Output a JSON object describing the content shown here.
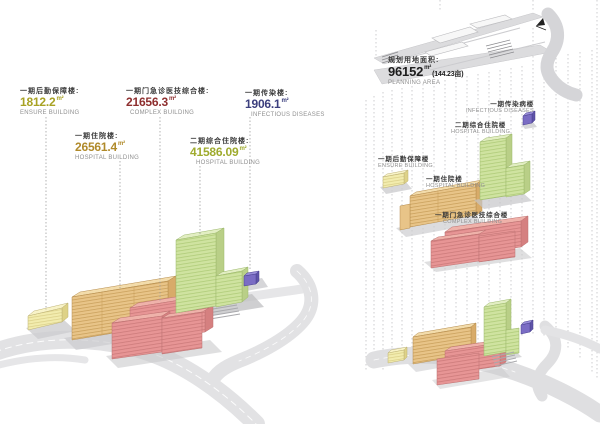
{
  "diagram_left": {
    "title": "phase-building-areas",
    "labels": [
      {
        "id": "ensure",
        "zh": "一期后勤保障楼:",
        "value": "1812.2",
        "unit": "m²",
        "en": "ENSURE BUILDING",
        "color": "#a8a224"
      },
      {
        "id": "complex",
        "zh": "一期门急诊医技综合楼:",
        "value": "21656.3",
        "unit": "m²",
        "en": "COMPLEX BUILDING",
        "color": "#8e2f2f"
      },
      {
        "id": "infectious",
        "zh": "一期传染楼:",
        "value": "1906.1",
        "unit": "m²",
        "en": "INFECTIOUS DISEASES",
        "color": "#3c3f7e"
      },
      {
        "id": "hospital1",
        "zh": "一期住院楼:",
        "value": "26561.4",
        "unit": "m²",
        "en": "HOSPITAL BUILDING",
        "color": "#b08a2a"
      },
      {
        "id": "hospital2",
        "zh": "二期综合住院楼:",
        "value": "41586.09",
        "unit": "m²",
        "en": "HOSPITAL BUILDING",
        "color": "#9fab2e"
      }
    ]
  },
  "diagram_right": {
    "title": "exploded-site-plan",
    "planning": {
      "zh": "规划用地面积:",
      "value": "96152",
      "unit": "m²",
      "extra": "(144.23亩)",
      "en": "PLANNING AREA",
      "color": "#1c1c1c"
    },
    "labels": [
      {
        "id": "infectious",
        "zh": "一期传染病楼",
        "en": "INFECTIOUS DISEASES"
      },
      {
        "id": "hospital2",
        "zh": "二期综合住院楼",
        "en": "HOSPITAL BUILDING"
      },
      {
        "id": "ensure",
        "zh": "一期后勤保障楼",
        "en": "ENSURE BUILDING"
      },
      {
        "id": "hospital1",
        "zh": "一期住院楼",
        "en": "HOSPITAL BUILDING"
      },
      {
        "id": "complex",
        "zh": "一期门急诊医技综合楼",
        "en": "COMPLEX BUILDING"
      }
    ]
  },
  "legend_colors": {
    "ensure_building": "#f2ecae",
    "hospital_phase1": "#e8c488",
    "complex_building": "#e79595",
    "hospital_phase2": "#cfe3a0",
    "infectious_building": "#7a6cc4",
    "road": "#e2e2e4"
  }
}
